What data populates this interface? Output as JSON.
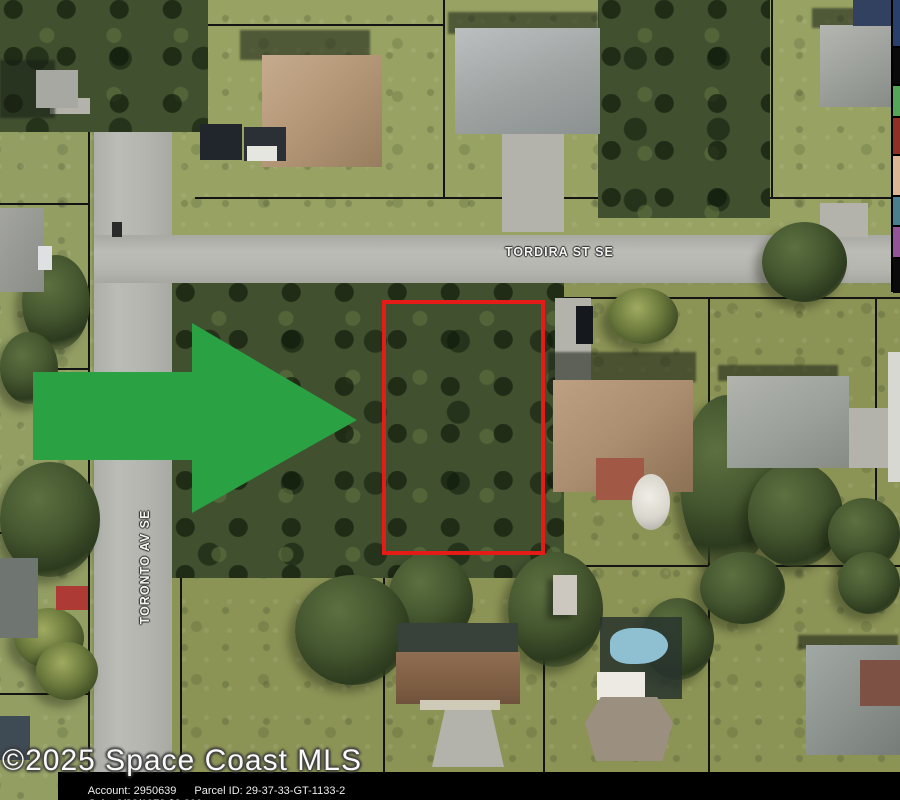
{
  "map": {
    "type": "aerial-parcel-map",
    "street_labels": [
      {
        "name": "TORDIRA ST SE",
        "orientation": "horizontal"
      },
      {
        "name": "TORONTO AV SE",
        "orientation": "vertical"
      }
    ],
    "subject_parcel": {
      "outline_color": "#e41b17"
    },
    "arrow_color": "#2aa143",
    "watermark": "©2025 Space Coast MLS",
    "footer": {
      "account": "Account: 2950639",
      "parcel_id": "Parcel ID: 29-37-33-GT-1133-2",
      "sale": "Sale: 8/22/1972 $3,200"
    },
    "legend_swatches": [
      "#28406b",
      "#0a0a0a",
      "#55a658",
      "#8f2f26",
      "#dcb795",
      "#4a7f8e",
      "#935397",
      "#0a0a0a"
    ]
  }
}
